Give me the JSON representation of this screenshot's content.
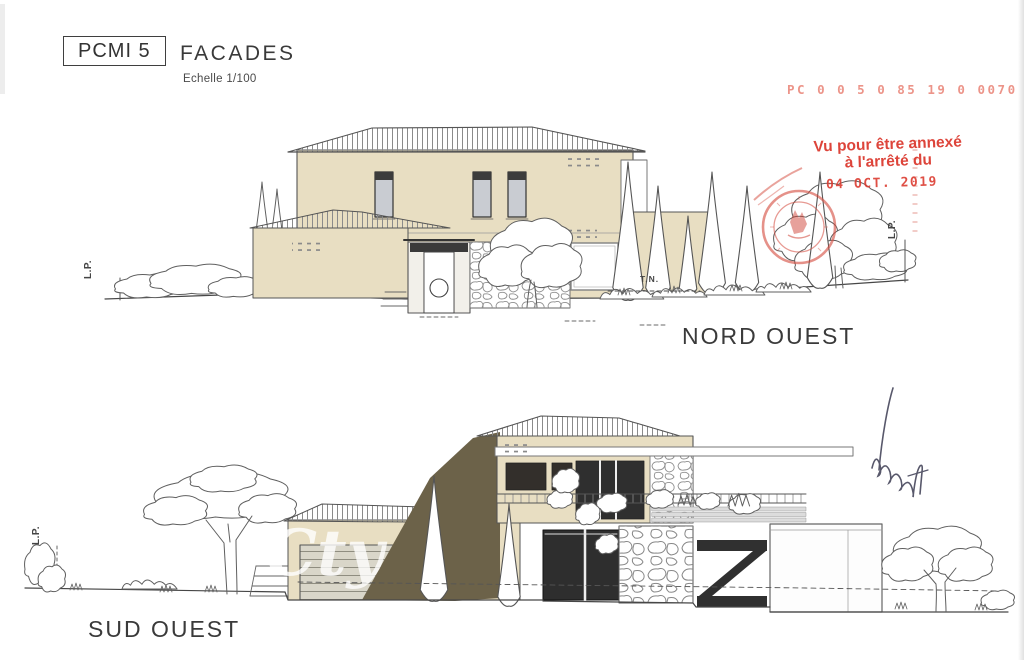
{
  "title_block": {
    "code": "PCMI 5",
    "title": "FACADES",
    "scale": "Echelle 1/100"
  },
  "stamps": {
    "pc_number": "PC  0 0 5 0 85 19 0 0070",
    "approval_line1": "Vu pour être annexé",
    "approval_line2": "à l'arrêté du",
    "date": "04 OCT. 2019",
    "stamp_red": "#da362c"
  },
  "elevations": {
    "northwest": {
      "name": "NORD OUEST",
      "lp_left": "L.P.",
      "lp_right": "L.P.",
      "tn": "T.N."
    },
    "southwest": {
      "name": "SUD OUEST",
      "lp_left": "L.P."
    }
  },
  "watermark": {
    "text": "Cty"
  },
  "colors": {
    "wall_beige": "#e8dec2",
    "shadow_olive": "#6c6249",
    "glazing_dark": "#2e2e2e",
    "line_ink": "#555555",
    "signature_ink": "#3c3c52"
  }
}
